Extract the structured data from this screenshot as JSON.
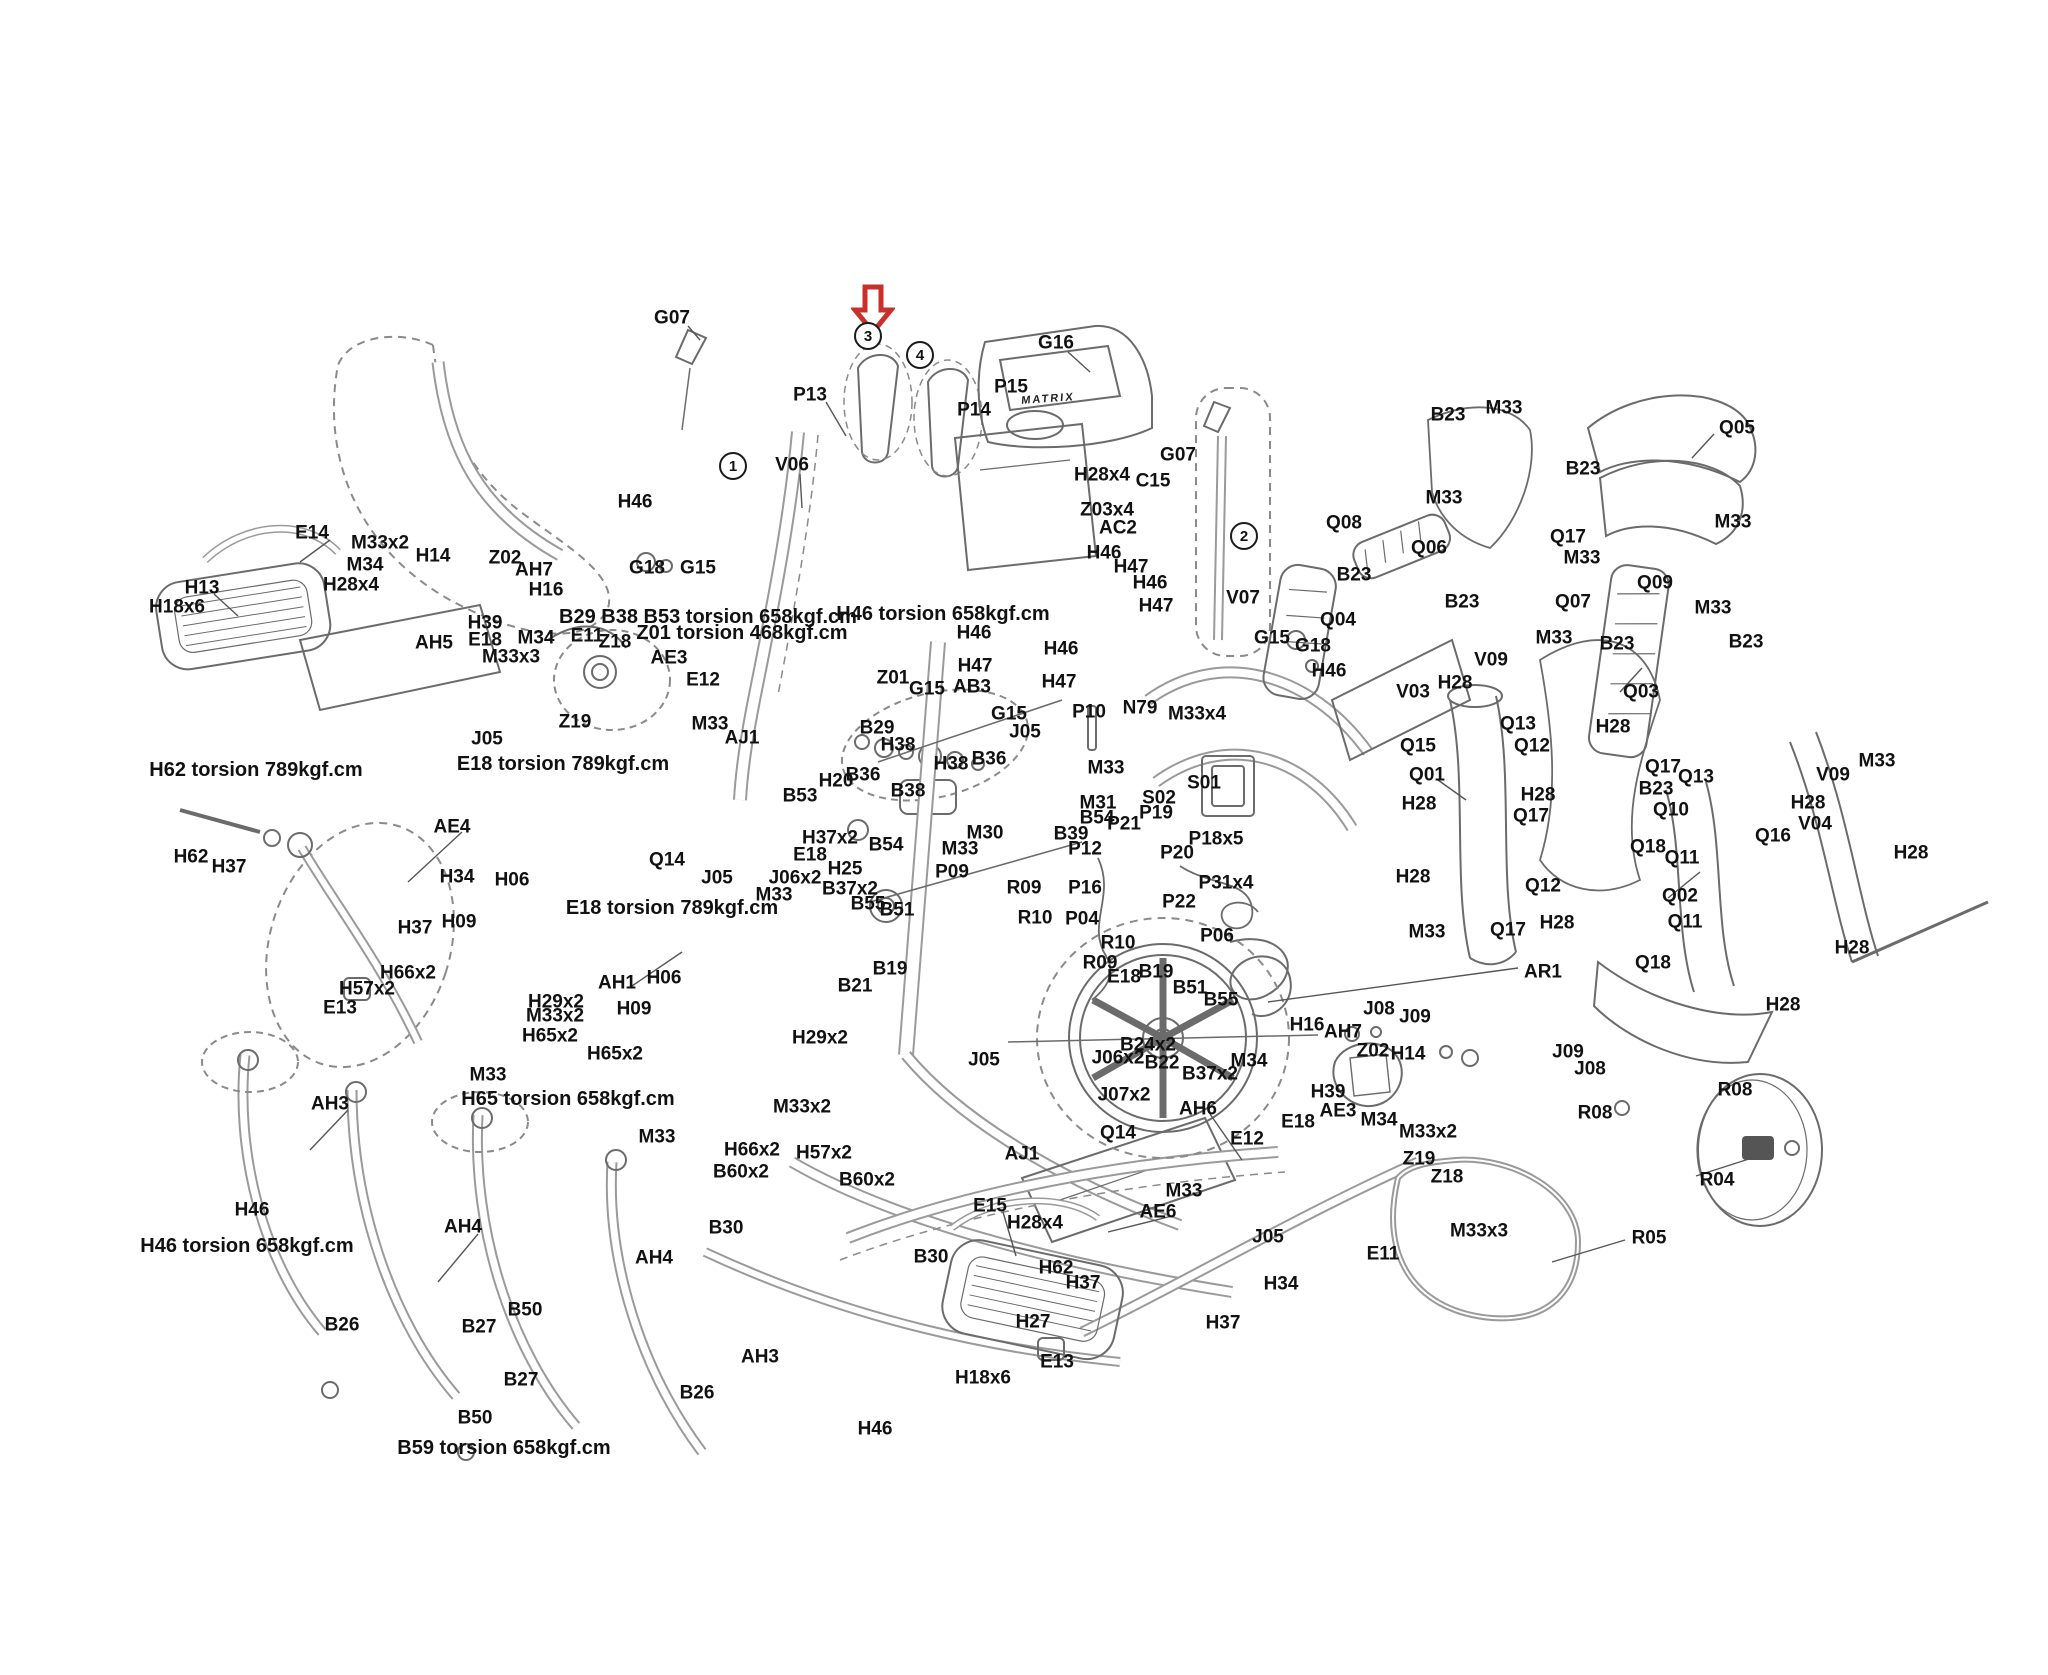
{
  "canvas": {
    "width": 2048,
    "height": 1675,
    "background": "#ffffff",
    "line_color": "#6b6b6b",
    "label_color": "#111111"
  },
  "arrow_marker": {
    "name": "red-arrow",
    "color": "#c9302c",
    "x": 873,
    "y": 284
  },
  "brand_text": {
    "text": "MATRIX",
    "x": 1048,
    "y": 399
  },
  "callouts": [
    {
      "n": "1",
      "x": 733,
      "y": 466
    },
    {
      "n": "2",
      "x": 1244,
      "y": 536
    },
    {
      "n": "3",
      "x": 868,
      "y": 336
    },
    {
      "n": "4",
      "x": 920,
      "y": 355
    }
  ],
  "notes": [
    {
      "t": "H62 torsion 789kgf.cm",
      "x": 256,
      "y": 770
    },
    {
      "t": "E18 torsion 789kgf.cm",
      "x": 563,
      "y": 764
    },
    {
      "t": "B29 B38 B53 torsion 658kgf.cm",
      "x": 708,
      "y": 617
    },
    {
      "t": "Z01 torsion 468kgf.cm",
      "x": 742,
      "y": 633
    },
    {
      "t": "H46 torsion 658kgf.cm",
      "x": 943,
      "y": 614
    },
    {
      "t": "E18 torsion 789kgf.cm",
      "x": 672,
      "y": 908
    },
    {
      "t": "H65 torsion 658kgf.cm",
      "x": 568,
      "y": 1099
    },
    {
      "t": "H46 torsion 658kgf.cm",
      "x": 247,
      "y": 1246
    },
    {
      "t": "B59 torsion 658kgf.cm",
      "x": 504,
      "y": 1448
    }
  ],
  "labels": [
    {
      "t": "G07",
      "x": 672,
      "y": 318
    },
    {
      "t": "P13",
      "x": 810,
      "y": 395
    },
    {
      "t": "V06",
      "x": 792,
      "y": 465
    },
    {
      "t": "H46",
      "x": 635,
      "y": 502
    },
    {
      "t": "G18",
      "x": 647,
      "y": 568
    },
    {
      "t": "G15",
      "x": 698,
      "y": 568
    },
    {
      "t": "P14",
      "x": 974,
      "y": 410
    },
    {
      "t": "P15",
      "x": 1011,
      "y": 387
    },
    {
      "t": "G16",
      "x": 1056,
      "y": 343
    },
    {
      "t": "H28x4",
      "x": 1102,
      "y": 475
    },
    {
      "t": "C15",
      "x": 1153,
      "y": 481
    },
    {
      "t": "G07",
      "x": 1178,
      "y": 455
    },
    {
      "t": "Z03x4",
      "x": 1107,
      "y": 510
    },
    {
      "t": "AC2",
      "x": 1118,
      "y": 528
    },
    {
      "t": "H46",
      "x": 1104,
      "y": 553
    },
    {
      "t": "H47",
      "x": 1131,
      "y": 567
    },
    {
      "t": "H46",
      "x": 1150,
      "y": 583
    },
    {
      "t": "H47",
      "x": 1156,
      "y": 606
    },
    {
      "t": "V07",
      "x": 1243,
      "y": 598
    },
    {
      "t": "G15",
      "x": 1272,
      "y": 638
    },
    {
      "t": "H46",
      "x": 974,
      "y": 633
    },
    {
      "t": "H46",
      "x": 1061,
      "y": 649
    },
    {
      "t": "H47",
      "x": 975,
      "y": 666
    },
    {
      "t": "H47",
      "x": 1059,
      "y": 682
    },
    {
      "t": "B23",
      "x": 1448,
      "y": 415
    },
    {
      "t": "M33",
      "x": 1504,
      "y": 408
    },
    {
      "t": "M33",
      "x": 1444,
      "y": 498
    },
    {
      "t": "Q08",
      "x": 1344,
      "y": 523
    },
    {
      "t": "Q06",
      "x": 1429,
      "y": 548
    },
    {
      "t": "B23",
      "x": 1354,
      "y": 575
    },
    {
      "t": "B23",
      "x": 1462,
      "y": 602
    },
    {
      "t": "Q05",
      "x": 1737,
      "y": 428
    },
    {
      "t": "B23",
      "x": 1583,
      "y": 469
    },
    {
      "t": "Q17",
      "x": 1568,
      "y": 537
    },
    {
      "t": "M33",
      "x": 1582,
      "y": 558
    },
    {
      "t": "M33",
      "x": 1733,
      "y": 522
    },
    {
      "t": "Q09",
      "x": 1655,
      "y": 583
    },
    {
      "t": "Q07",
      "x": 1573,
      "y": 602
    },
    {
      "t": "M33",
      "x": 1713,
      "y": 608
    },
    {
      "t": "B23",
      "x": 1746,
      "y": 642
    },
    {
      "t": "E14",
      "x": 312,
      "y": 533
    },
    {
      "t": "M33x2",
      "x": 380,
      "y": 543
    },
    {
      "t": "M34",
      "x": 365,
      "y": 565
    },
    {
      "t": "H14",
      "x": 433,
      "y": 556
    },
    {
      "t": "H13",
      "x": 202,
      "y": 588
    },
    {
      "t": "H18x6",
      "x": 177,
      "y": 607
    },
    {
      "t": "H28x4",
      "x": 351,
      "y": 585
    },
    {
      "t": "Z02",
      "x": 505,
      "y": 558
    },
    {
      "t": "AH7",
      "x": 534,
      "y": 570
    },
    {
      "t": "H16",
      "x": 546,
      "y": 590
    },
    {
      "t": "H39",
      "x": 485,
      "y": 623
    },
    {
      "t": "AH5",
      "x": 434,
      "y": 643
    },
    {
      "t": "E18",
      "x": 485,
      "y": 640
    },
    {
      "t": "M34",
      "x": 536,
      "y": 638
    },
    {
      "t": "E11",
      "x": 587,
      "y": 636
    },
    {
      "t": "M33x3",
      "x": 511,
      "y": 657
    },
    {
      "t": "J05",
      "x": 487,
      "y": 739
    },
    {
      "t": "Z19",
      "x": 575,
      "y": 722
    },
    {
      "t": "Z18",
      "x": 615,
      "y": 642
    },
    {
      "t": "AE3",
      "x": 669,
      "y": 658
    },
    {
      "t": "E12",
      "x": 703,
      "y": 680
    },
    {
      "t": "M33",
      "x": 710,
      "y": 724
    },
    {
      "t": "AJ1",
      "x": 742,
      "y": 738
    },
    {
      "t": "AE4",
      "x": 452,
      "y": 827
    },
    {
      "t": "H62",
      "x": 191,
      "y": 857
    },
    {
      "t": "H37",
      "x": 229,
      "y": 867
    },
    {
      "t": "H34",
      "x": 457,
      "y": 877
    },
    {
      "t": "H37",
      "x": 415,
      "y": 928
    },
    {
      "t": "H06",
      "x": 512,
      "y": 880
    },
    {
      "t": "H09",
      "x": 459,
      "y": 922
    },
    {
      "t": "E13",
      "x": 340,
      "y": 1008
    },
    {
      "t": "Z01",
      "x": 893,
      "y": 678
    },
    {
      "t": "G15",
      "x": 927,
      "y": 689
    },
    {
      "t": "AB3",
      "x": 972,
      "y": 687
    },
    {
      "t": "G15",
      "x": 1009,
      "y": 714
    },
    {
      "t": "J05",
      "x": 1025,
      "y": 732
    },
    {
      "t": "B29",
      "x": 877,
      "y": 728
    },
    {
      "t": "H38",
      "x": 898,
      "y": 745
    },
    {
      "t": "H38",
      "x": 951,
      "y": 764
    },
    {
      "t": "B36",
      "x": 989,
      "y": 759
    },
    {
      "t": "B36",
      "x": 863,
      "y": 775
    },
    {
      "t": "H20",
      "x": 836,
      "y": 781
    },
    {
      "t": "B38",
      "x": 908,
      "y": 791
    },
    {
      "t": "B53",
      "x": 800,
      "y": 796
    },
    {
      "t": "B54",
      "x": 886,
      "y": 845
    },
    {
      "t": "H37x2",
      "x": 830,
      "y": 838
    },
    {
      "t": "B37x2",
      "x": 850,
      "y": 889
    },
    {
      "t": "M30",
      "x": 985,
      "y": 833
    },
    {
      "t": "M33",
      "x": 960,
      "y": 849
    },
    {
      "t": "P09",
      "x": 952,
      "y": 872
    },
    {
      "t": "H25",
      "x": 845,
      "y": 869
    },
    {
      "t": "E18",
      "x": 810,
      "y": 855
    },
    {
      "t": "J06x2",
      "x": 795,
      "y": 878
    },
    {
      "t": "J05",
      "x": 717,
      "y": 878
    },
    {
      "t": "M33",
      "x": 774,
      "y": 895
    },
    {
      "t": "Q14",
      "x": 667,
      "y": 860
    },
    {
      "t": "B55",
      "x": 868,
      "y": 904
    },
    {
      "t": "B51",
      "x": 897,
      "y": 910
    },
    {
      "t": "B19",
      "x": 890,
      "y": 969
    },
    {
      "t": "B21",
      "x": 855,
      "y": 986
    },
    {
      "t": "P10",
      "x": 1089,
      "y": 712
    },
    {
      "t": "N79",
      "x": 1140,
      "y": 708
    },
    {
      "t": "M33x4",
      "x": 1197,
      "y": 714
    },
    {
      "t": "S01",
      "x": 1204,
      "y": 783
    },
    {
      "t": "S02",
      "x": 1159,
      "y": 798
    },
    {
      "t": "M33",
      "x": 1106,
      "y": 768
    },
    {
      "t": "M31",
      "x": 1098,
      "y": 803
    },
    {
      "t": "B54",
      "x": 1097,
      "y": 818
    },
    {
      "t": "P21",
      "x": 1124,
      "y": 824
    },
    {
      "t": "P19",
      "x": 1156,
      "y": 813
    },
    {
      "t": "P18x5",
      "x": 1216,
      "y": 839
    },
    {
      "t": "P20",
      "x": 1177,
      "y": 853
    },
    {
      "t": "P12",
      "x": 1085,
      "y": 849
    },
    {
      "t": "P16",
      "x": 1085,
      "y": 888
    },
    {
      "t": "P04",
      "x": 1082,
      "y": 919
    },
    {
      "t": "P22",
      "x": 1179,
      "y": 902
    },
    {
      "t": "P31x4",
      "x": 1226,
      "y": 883
    },
    {
      "t": "P06",
      "x": 1217,
      "y": 936
    },
    {
      "t": "B39",
      "x": 1071,
      "y": 834
    },
    {
      "t": "R09",
      "x": 1024,
      "y": 888
    },
    {
      "t": "R10",
      "x": 1035,
      "y": 918
    },
    {
      "t": "R10",
      "x": 1118,
      "y": 943
    },
    {
      "t": "R09",
      "x": 1100,
      "y": 963
    },
    {
      "t": "E18",
      "x": 1124,
      "y": 977
    },
    {
      "t": "B19",
      "x": 1156,
      "y": 972
    },
    {
      "t": "B51",
      "x": 1190,
      "y": 988
    },
    {
      "t": "B55",
      "x": 1221,
      "y": 1000
    },
    {
      "t": "B24x2",
      "x": 1148,
      "y": 1045
    },
    {
      "t": "J06x2",
      "x": 1118,
      "y": 1058
    },
    {
      "t": "B22",
      "x": 1162,
      "y": 1063
    },
    {
      "t": "B37x2",
      "x": 1210,
      "y": 1074
    },
    {
      "t": "J07x2",
      "x": 1124,
      "y": 1095
    },
    {
      "t": "Q14",
      "x": 1118,
      "y": 1133
    },
    {
      "t": "AJ1",
      "x": 1022,
      "y": 1154
    },
    {
      "t": "J05",
      "x": 984,
      "y": 1060
    },
    {
      "t": "H29x2",
      "x": 820,
      "y": 1038
    },
    {
      "t": "H66x2",
      "x": 408,
      "y": 973
    },
    {
      "t": "H57x2",
      "x": 367,
      "y": 989
    },
    {
      "t": "H29x2",
      "x": 556,
      "y": 1002
    },
    {
      "t": "M33x2",
      "x": 555,
      "y": 1016
    },
    {
      "t": "H65x2",
      "x": 550,
      "y": 1036
    },
    {
      "t": "M33",
      "x": 488,
      "y": 1075
    },
    {
      "t": "AH1",
      "x": 617,
      "y": 983
    },
    {
      "t": "H06",
      "x": 664,
      "y": 978
    },
    {
      "t": "H09",
      "x": 634,
      "y": 1009
    },
    {
      "t": "H65x2",
      "x": 615,
      "y": 1054
    },
    {
      "t": "M33",
      "x": 657,
      "y": 1137
    },
    {
      "t": "H66x2",
      "x": 752,
      "y": 1150
    },
    {
      "t": "H57x2",
      "x": 824,
      "y": 1153
    },
    {
      "t": "B60x2",
      "x": 741,
      "y": 1172
    },
    {
      "t": "B60x2",
      "x": 867,
      "y": 1180
    },
    {
      "t": "M33x2",
      "x": 802,
      "y": 1107
    },
    {
      "t": "AH3",
      "x": 330,
      "y": 1104
    },
    {
      "t": "H46",
      "x": 252,
      "y": 1210
    },
    {
      "t": "B30",
      "x": 726,
      "y": 1228
    },
    {
      "t": "B30",
      "x": 931,
      "y": 1257
    },
    {
      "t": "AH4",
      "x": 654,
      "y": 1258
    },
    {
      "t": "AH4",
      "x": 463,
      "y": 1227
    },
    {
      "t": "B26",
      "x": 342,
      "y": 1325
    },
    {
      "t": "B27",
      "x": 479,
      "y": 1327
    },
    {
      "t": "B50",
      "x": 525,
      "y": 1310
    },
    {
      "t": "B27",
      "x": 521,
      "y": 1380
    },
    {
      "t": "B50",
      "x": 475,
      "y": 1418
    },
    {
      "t": "AH3",
      "x": 760,
      "y": 1357
    },
    {
      "t": "B26",
      "x": 697,
      "y": 1393
    },
    {
      "t": "H46",
      "x": 875,
      "y": 1429
    },
    {
      "t": "E15",
      "x": 990,
      "y": 1206
    },
    {
      "t": "H28x4",
      "x": 1035,
      "y": 1223
    },
    {
      "t": "H62",
      "x": 1056,
      "y": 1268
    },
    {
      "t": "H37",
      "x": 1083,
      "y": 1283
    },
    {
      "t": "H27",
      "x": 1033,
      "y": 1322
    },
    {
      "t": "E13",
      "x": 1057,
      "y": 1362
    },
    {
      "t": "H18x6",
      "x": 983,
      "y": 1378
    },
    {
      "t": "AE6",
      "x": 1158,
      "y": 1212
    },
    {
      "t": "M33",
      "x": 1184,
      "y": 1191
    },
    {
      "t": "E12",
      "x": 1247,
      "y": 1139
    },
    {
      "t": "AH6",
      "x": 1198,
      "y": 1109
    },
    {
      "t": "J05",
      "x": 1268,
      "y": 1237
    },
    {
      "t": "H34",
      "x": 1281,
      "y": 1284
    },
    {
      "t": "H37",
      "x": 1223,
      "y": 1323
    },
    {
      "t": "M34",
      "x": 1249,
      "y": 1061
    },
    {
      "t": "H16",
      "x": 1307,
      "y": 1025
    },
    {
      "t": "AH7",
      "x": 1343,
      "y": 1032
    },
    {
      "t": "J08",
      "x": 1379,
      "y": 1009
    },
    {
      "t": "J09",
      "x": 1415,
      "y": 1017
    },
    {
      "t": "Z02",
      "x": 1373,
      "y": 1051
    },
    {
      "t": "H14",
      "x": 1408,
      "y": 1054
    },
    {
      "t": "H39",
      "x": 1328,
      "y": 1092
    },
    {
      "t": "M34",
      "x": 1379,
      "y": 1120
    },
    {
      "t": "M33x2",
      "x": 1428,
      "y": 1132
    },
    {
      "t": "E18",
      "x": 1298,
      "y": 1122
    },
    {
      "t": "AE3",
      "x": 1338,
      "y": 1111
    },
    {
      "t": "Z19",
      "x": 1419,
      "y": 1159
    },
    {
      "t": "Z18",
      "x": 1447,
      "y": 1177
    },
    {
      "t": "M33x3",
      "x": 1479,
      "y": 1231
    },
    {
      "t": "E11",
      "x": 1383,
      "y": 1254
    },
    {
      "t": "AR1",
      "x": 1543,
      "y": 972
    },
    {
      "t": "M33",
      "x": 1427,
      "y": 932
    },
    {
      "t": "Q17",
      "x": 1508,
      "y": 930
    },
    {
      "t": "J09",
      "x": 1568,
      "y": 1052
    },
    {
      "t": "J08",
      "x": 1590,
      "y": 1069
    },
    {
      "t": "R08",
      "x": 1595,
      "y": 1113
    },
    {
      "t": "R08",
      "x": 1735,
      "y": 1090
    },
    {
      "t": "R04",
      "x": 1717,
      "y": 1180
    },
    {
      "t": "R05",
      "x": 1649,
      "y": 1238
    },
    {
      "t": "Q18",
      "x": 1648,
      "y": 847
    },
    {
      "t": "Q11",
      "x": 1682,
      "y": 858
    },
    {
      "t": "Q18",
      "x": 1653,
      "y": 963
    },
    {
      "t": "Q11",
      "x": 1685,
      "y": 922
    },
    {
      "t": "Q04",
      "x": 1338,
      "y": 620
    },
    {
      "t": "G18",
      "x": 1313,
      "y": 646
    },
    {
      "t": "H46",
      "x": 1329,
      "y": 671
    },
    {
      "t": "V03",
      "x": 1413,
      "y": 692
    },
    {
      "t": "H28",
      "x": 1455,
      "y": 683
    },
    {
      "t": "V09",
      "x": 1491,
      "y": 660
    },
    {
      "t": "M33",
      "x": 1554,
      "y": 638
    },
    {
      "t": "B23",
      "x": 1617,
      "y": 644
    },
    {
      "t": "Q03",
      "x": 1641,
      "y": 692
    },
    {
      "t": "Q15",
      "x": 1418,
      "y": 746
    },
    {
      "t": "Q13",
      "x": 1518,
      "y": 724
    },
    {
      "t": "Q12",
      "x": 1532,
      "y": 746
    },
    {
      "t": "Q01",
      "x": 1427,
      "y": 775
    },
    {
      "t": "H28",
      "x": 1538,
      "y": 795
    },
    {
      "t": "H28",
      "x": 1419,
      "y": 804
    },
    {
      "t": "Q17",
      "x": 1531,
      "y": 816
    },
    {
      "t": "H28",
      "x": 1613,
      "y": 727
    },
    {
      "t": "Q17",
      "x": 1663,
      "y": 767
    },
    {
      "t": "B23",
      "x": 1656,
      "y": 789
    },
    {
      "t": "Q10",
      "x": 1671,
      "y": 810
    },
    {
      "t": "Q13",
      "x": 1696,
      "y": 777
    },
    {
      "t": "H28",
      "x": 1413,
      "y": 877
    },
    {
      "t": "Q12",
      "x": 1543,
      "y": 886
    },
    {
      "t": "H28",
      "x": 1557,
      "y": 923
    },
    {
      "t": "Q02",
      "x": 1680,
      "y": 896
    },
    {
      "t": "V09",
      "x": 1833,
      "y": 775
    },
    {
      "t": "M33",
      "x": 1877,
      "y": 761
    },
    {
      "t": "H28",
      "x": 1808,
      "y": 803
    },
    {
      "t": "V04",
      "x": 1815,
      "y": 824
    },
    {
      "t": "Q16",
      "x": 1773,
      "y": 836
    },
    {
      "t": "H28",
      "x": 1911,
      "y": 853
    },
    {
      "t": "H28",
      "x": 1852,
      "y": 948
    },
    {
      "t": "H28",
      "x": 1783,
      "y": 1005
    }
  ]
}
